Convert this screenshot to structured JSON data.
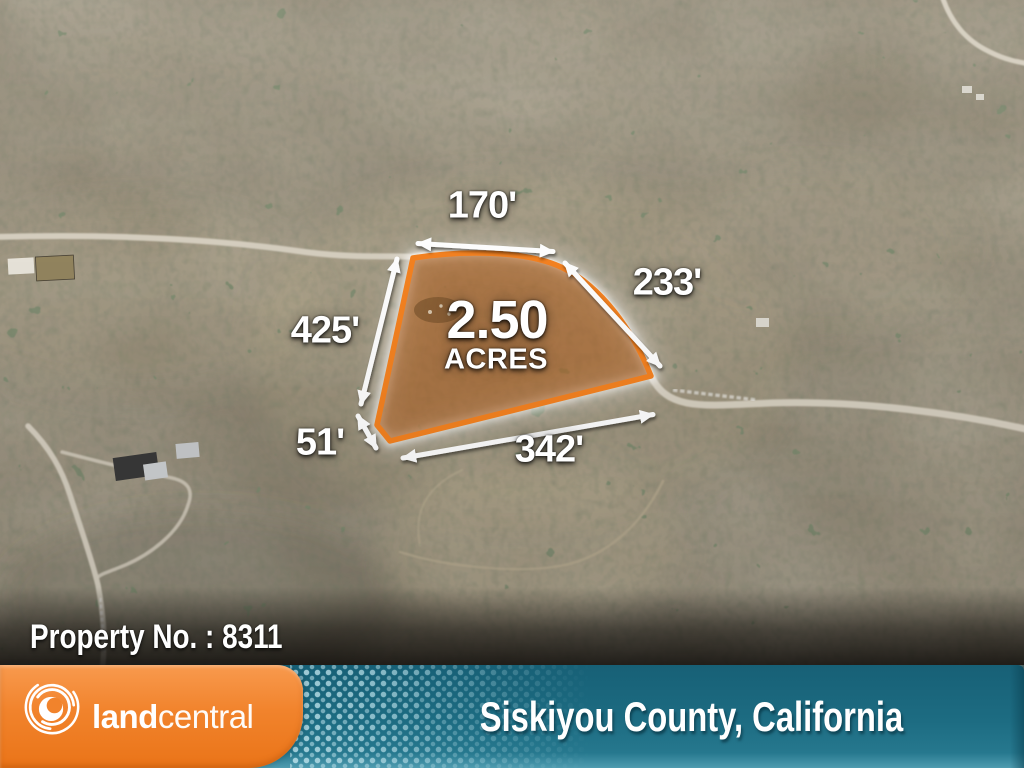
{
  "map": {
    "acreage": "2.50",
    "acres_label": "ACRES",
    "dimensions": {
      "top": "170'",
      "right": "233'",
      "left": "425'",
      "bottom_left": "51'",
      "bottom": "342'"
    },
    "property_label": "Property No. : 8311"
  },
  "footer": {
    "brand": {
      "bold": "land",
      "light": "central"
    },
    "location": "Siskiyou County, California"
  },
  "colors": {
    "boundary_orange": "#f58220",
    "brand_orange": "#f1832c",
    "footer_teal": "#1d6c82",
    "label_white": "#ffffff"
  }
}
